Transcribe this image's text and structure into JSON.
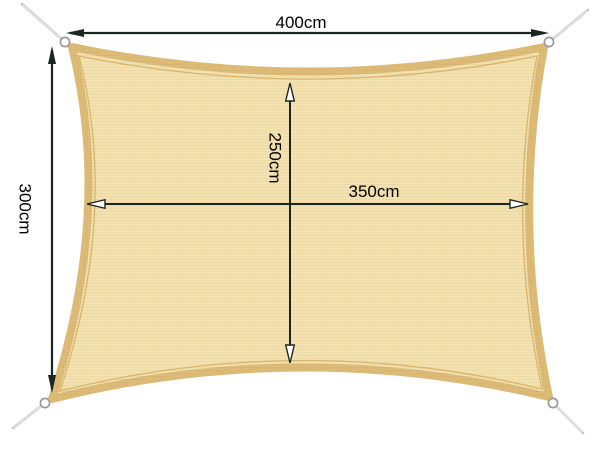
{
  "diagram": {
    "kind": "shade-sail-dimension-diagram",
    "sail": {
      "fill": "#f3e0ac",
      "hem_color": "#dcba76",
      "seam_color": "#d2ad62"
    },
    "hardware": {
      "ring_fill": "#ffffff",
      "ring_stroke": "#9a9a9a",
      "rope_color": "#c6c6c6"
    },
    "annotation": {
      "line_color": "#1c2620",
      "text_color": "#000000"
    },
    "measurements": {
      "top_width": "400cm",
      "left_height": "300cm",
      "inner_height": "250cm",
      "inner_width": "350cm"
    }
  }
}
